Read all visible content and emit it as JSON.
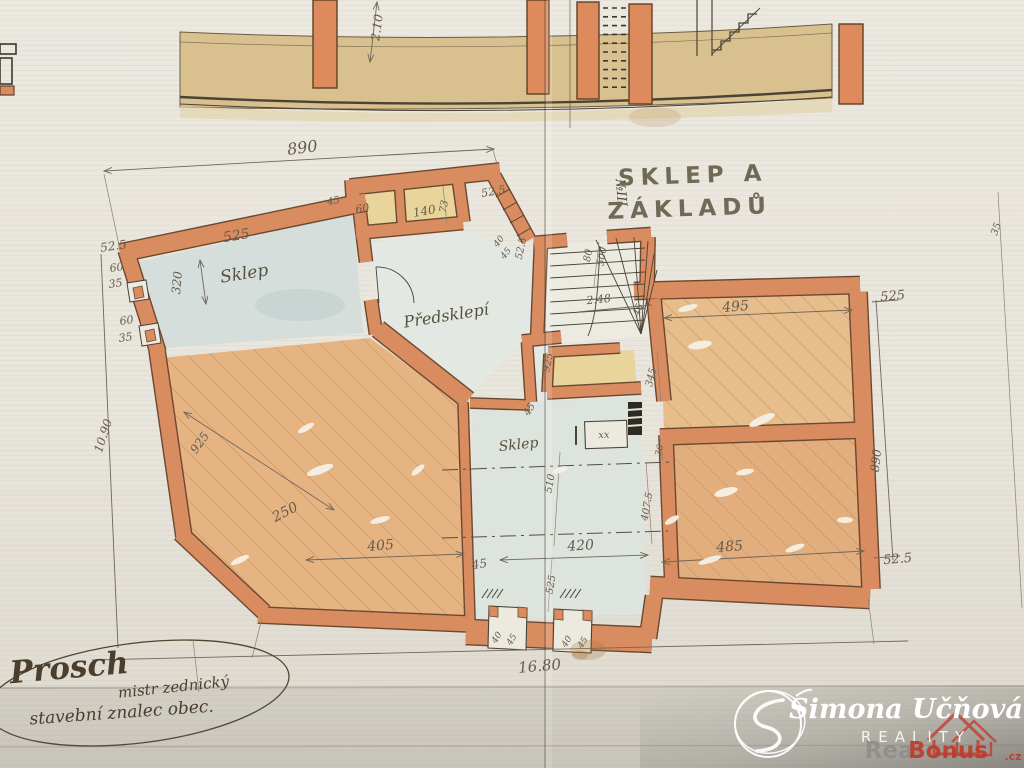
{
  "document": {
    "type": "historic cellar floor plan (hand drawn)",
    "title_line1": "SKLEP A",
    "title_line2": "ZÁKLADŮ"
  },
  "palette": {
    "paper": "#e9e6de",
    "wall_orange": "#d98c5f",
    "wall_outline": "#6b4930",
    "hatch": "#a87b41",
    "blue_wash": "#d5dedb",
    "yellow_wash": "#e9d49c",
    "ink": "#4a4336",
    "watermark_white": "#ffffff",
    "watermark_gray": "#8d8d8b",
    "watermark_red": "#bf3a2c"
  },
  "labels": [
    {
      "n": "dim-210-section",
      "t": "2.10",
      "x": 381,
      "y": 28,
      "r": -82,
      "s": 12
    },
    {
      "n": "dim-890-top",
      "t": "890",
      "x": 303,
      "y": 153,
      "r": -7,
      "s": 16
    },
    {
      "n": "dim-525-sklep-tl",
      "t": "525",
      "x": 237,
      "y": 240,
      "r": -9,
      "s": 14
    },
    {
      "n": "room-label-sklep-tl",
      "t": "Sklep",
      "x": 245,
      "y": 279,
      "r": -9,
      "s": 17,
      "c": "room"
    },
    {
      "n": "dim-525-left-top",
      "t": "52.5",
      "x": 114,
      "y": 250,
      "r": -8,
      "s": 12
    },
    {
      "n": "dim-60-left-1",
      "t": "60",
      "x": 117,
      "y": 271,
      "r": -8,
      "s": 11
    },
    {
      "n": "dim-35-left-1",
      "t": "35",
      "x": 116,
      "y": 287,
      "r": -8,
      "s": 11
    },
    {
      "n": "dim-320-left",
      "t": "320",
      "x": 181,
      "y": 283,
      "r": -85,
      "s": 12
    },
    {
      "n": "dim-60-left-2",
      "t": "60",
      "x": 127,
      "y": 324,
      "r": -8,
      "s": 11
    },
    {
      "n": "dim-35-left-2",
      "t": "35",
      "x": 126,
      "y": 341,
      "r": -8,
      "s": 11
    },
    {
      "n": "dim-1090-left",
      "t": "10.90",
      "x": 107,
      "y": 437,
      "r": -72,
      "s": 12
    },
    {
      "n": "dim-45-top",
      "t": "45",
      "x": 334,
      "y": 204,
      "r": -10,
      "s": 10
    },
    {
      "n": "dim-60-room",
      "t": "60",
      "x": 363,
      "y": 212,
      "r": -10,
      "s": 11
    },
    {
      "n": "dim-140-room",
      "t": "140",
      "x": 425,
      "y": 215,
      "r": -10,
      "s": 12
    },
    {
      "n": "dim-73",
      "t": "73",
      "x": 447,
      "y": 207,
      "r": -80,
      "s": 10
    },
    {
      "n": "dim-525-top-mid",
      "t": "52.5",
      "x": 494,
      "y": 195,
      "r": -10,
      "s": 11
    },
    {
      "n": "dim-40-steps",
      "t": "40",
      "x": 501,
      "y": 243,
      "r": -52,
      "s": 9
    },
    {
      "n": "dim-45-steps",
      "t": "45",
      "x": 508,
      "y": 255,
      "r": -52,
      "s": 9
    },
    {
      "n": "dim-525-mid-v",
      "t": "52.5",
      "x": 524,
      "y": 249,
      "r": -78,
      "s": 10
    },
    {
      "n": "dim-80-stair",
      "t": "80",
      "x": 591,
      "y": 256,
      "r": -80,
      "s": 10
    },
    {
      "n": "dim-500-stair",
      "t": "500",
      "x": 605,
      "y": 257,
      "r": -80,
      "s": 10
    },
    {
      "n": "dim-248-stair",
      "t": "2.48",
      "x": 599,
      "y": 303,
      "r": -6,
      "s": 11
    },
    {
      "n": "room-label-predsklepi",
      "t": "Předsklepí",
      "x": 447,
      "y": 321,
      "r": -9,
      "s": 16,
      "c": "room"
    },
    {
      "n": "dim-925-stair",
      "t": "925",
      "x": 551,
      "y": 363,
      "r": -78,
      "s": 10
    },
    {
      "n": "dim-45-mid",
      "t": "45",
      "x": 532,
      "y": 411,
      "r": -58,
      "s": 10
    },
    {
      "n": "dim-45-wing",
      "t": "45",
      "x": 641,
      "y": 311,
      "r": -68,
      "s": 10
    },
    {
      "n": "dim-495-wing",
      "t": "495",
      "x": 736,
      "y": 311,
      "r": -5,
      "s": 14
    },
    {
      "n": "dim-345-wing",
      "t": "345",
      "x": 654,
      "y": 378,
      "r": -76,
      "s": 10
    },
    {
      "n": "dim-525-right-top",
      "t": "525",
      "x": 893,
      "y": 300,
      "r": -5,
      "s": 13
    },
    {
      "n": "dim-890-right",
      "t": "890",
      "x": 880,
      "y": 461,
      "r": -84,
      "s": 12
    },
    {
      "n": "dim-525-right-bottom",
      "t": "52.5",
      "x": 898,
      "y": 563,
      "r": -5,
      "s": 13
    },
    {
      "n": "dim-35-far-right",
      "t": "35",
      "x": 999,
      "y": 230,
      "r": -70,
      "s": 10
    },
    {
      "n": "marker-niii",
      "t": "№III",
      "x": 617,
      "y": 193,
      "r": 85,
      "s": 13,
      "c": "mk"
    },
    {
      "n": "dim-925-room",
      "t": "925",
      "x": 203,
      "y": 445,
      "r": -55,
      "s": 12
    },
    {
      "n": "dim-250-room",
      "t": "250",
      "x": 287,
      "y": 516,
      "r": -27,
      "s": 14
    },
    {
      "n": "dim-405-room",
      "t": "405",
      "x": 381,
      "y": 550,
      "r": -5,
      "s": 14
    },
    {
      "n": "dim-45-bottom-left",
      "t": "45",
      "x": 480,
      "y": 568,
      "r": -8,
      "s": 12
    },
    {
      "n": "room-label-sklep-center",
      "t": "Sklep",
      "x": 519,
      "y": 449,
      "r": -6,
      "s": 14,
      "c": "room"
    },
    {
      "n": "dim-510-center",
      "t": "510",
      "x": 553,
      "y": 484,
      "r": -80,
      "s": 10
    },
    {
      "n": "symbol-xx",
      "t": "xx",
      "x": 604,
      "y": 438,
      "r": -3,
      "s": 10
    },
    {
      "n": "dim-420-center",
      "t": "420",
      "x": 581,
      "y": 550,
      "r": -4,
      "s": 14
    },
    {
      "n": "dim-525-center-v",
      "t": "525",
      "x": 554,
      "y": 585,
      "r": -80,
      "s": 10
    },
    {
      "n": "dim-36-wing",
      "t": "36",
      "x": 662,
      "y": 451,
      "r": -76,
      "s": 9
    },
    {
      "n": "dim-4075-wing",
      "t": "407.5",
      "x": 650,
      "y": 507,
      "r": -80,
      "s": 10
    },
    {
      "n": "dim-485-wing",
      "t": "485",
      "x": 730,
      "y": 551,
      "r": -4,
      "s": 14
    },
    {
      "n": "dim-40-niche1",
      "t": "40",
      "x": 499,
      "y": 639,
      "r": -58,
      "s": 9
    },
    {
      "n": "dim-45-niche1",
      "t": "45",
      "x": 514,
      "y": 641,
      "r": -58,
      "s": 9
    },
    {
      "n": "dim-40-niche2",
      "t": "40",
      "x": 569,
      "y": 643,
      "r": -58,
      "s": 9
    },
    {
      "n": "dim-45-niche2",
      "t": "45",
      "x": 585,
      "y": 644,
      "r": -58,
      "s": 9
    },
    {
      "n": "dim-1680-bottom",
      "t": "16.80",
      "x": 540,
      "y": 671,
      "r": -5,
      "s": 15
    },
    {
      "n": "plan-title-line1",
      "t": "SKLEP A",
      "x": 693,
      "y": 183,
      "r": -2,
      "s": 23,
      "c": "t1"
    },
    {
      "n": "plan-title-line2",
      "t": "ZÁKLADŮ",
      "x": 690,
      "y": 216,
      "r": -2,
      "s": 23,
      "c": "t1"
    },
    {
      "n": "signature-name",
      "t": "Prosch",
      "x": 70,
      "y": 678,
      "r": -5,
      "s": 31,
      "c": "sg1"
    },
    {
      "n": "signature-role-1",
      "t": "mistr zednický",
      "x": 174,
      "y": 692,
      "r": -6,
      "s": 15,
      "c": "sg2"
    },
    {
      "n": "signature-role-2",
      "t": "stavební znalec obec.",
      "x": 122,
      "y": 718,
      "r": -4,
      "s": 17,
      "c": "sg2"
    },
    {
      "n": "watermark-name",
      "t": "Simona Učňová",
      "x": 906,
      "y": 718,
      "r": 0,
      "s": 27,
      "c": "wmn"
    },
    {
      "n": "watermark-reality",
      "t": "REALITY",
      "x": 916,
      "y": 742,
      "r": 0,
      "s": 15,
      "c": "wms"
    },
    {
      "n": "watermark-real",
      "t": "Real",
      "x": 893,
      "y": 758,
      "r": 0,
      "s": 23,
      "c": "wr",
      "a": "start"
    },
    {
      "n": "watermark-bonus",
      "t": "Bonus",
      "x": 948,
      "y": 758,
      "r": 0,
      "s": 23,
      "c": "wb",
      "a": "start"
    },
    {
      "n": "watermark-cz",
      "t": ".cz",
      "x": 1013,
      "y": 760,
      "r": 0,
      "s": 11,
      "c": "wb",
      "a": "start"
    }
  ]
}
